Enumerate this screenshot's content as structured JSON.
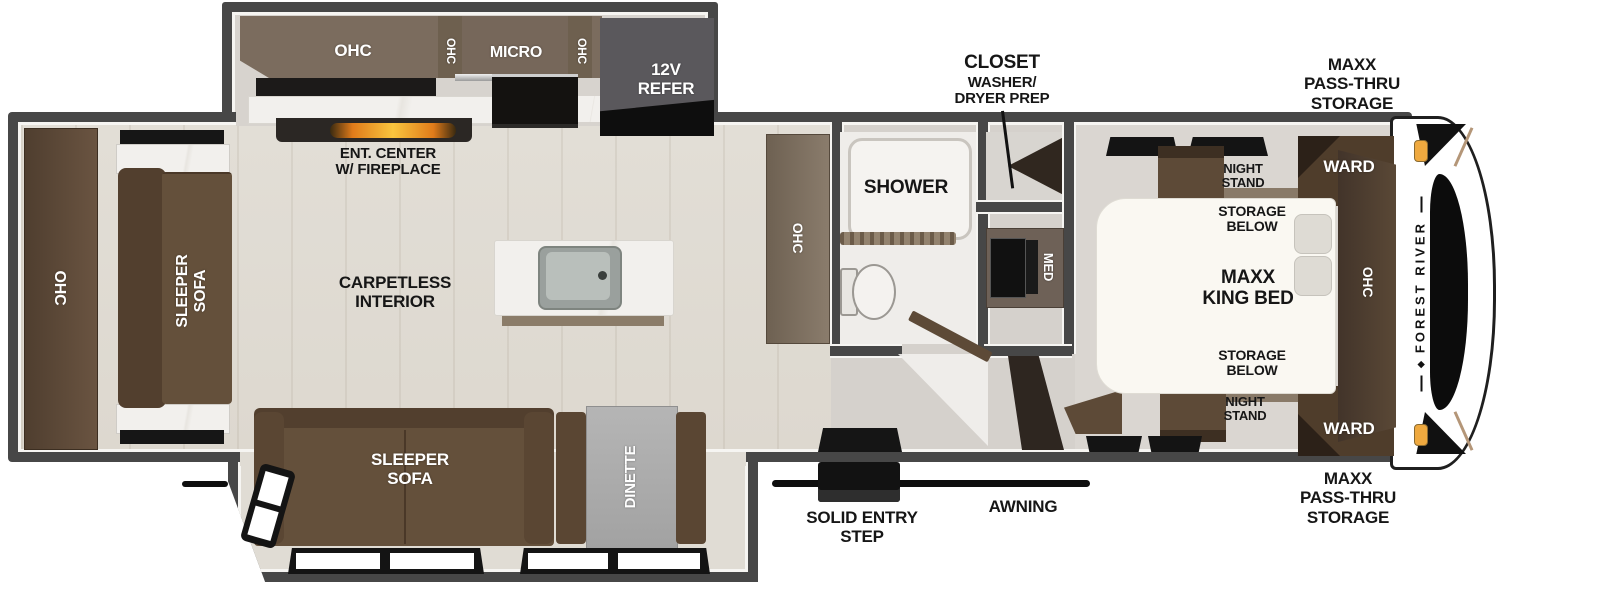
{
  "floorplan": {
    "kitchen": {
      "ohc": "OHC",
      "ohc_vert_left": "OHC",
      "micro": "MICRO",
      "ohc_vert_right": "OHC",
      "refer": "12V\nREFER",
      "ent_center": "ENT. CENTER\nW/ FIREPLACE"
    },
    "living": {
      "rear_ohc": "OHC",
      "rear_sleeper_sofa": "SLEEPER\nSOFA",
      "carpetless": "CARPETLESS\nINTERIOR",
      "sleeper_sofa": "SLEEPER\nSOFA",
      "dinette": "DINETTE",
      "pantry_ohc": "OHC"
    },
    "bath": {
      "shower": "SHOWER",
      "med": "MED",
      "closet_title": "CLOSET",
      "closet_sub": "WASHER/\nDRYER PREP"
    },
    "bedroom": {
      "night_stand_top": "NIGHT\nSTAND",
      "ward_top": "WARD",
      "storage_below_top": "STORAGE\nBELOW",
      "king_bed": "MAXX\nKING BED",
      "storage_below_bottom": "STORAGE\nBELOW",
      "night_stand_bottom": "NIGHT\nSTAND",
      "ward_bottom": "WARD",
      "ohc": "OHC"
    },
    "exterior": {
      "pass_thru_top": "MAXX\nPASS-THRU\nSTORAGE",
      "pass_thru_bottom": "MAXX\nPASS-THRU\nSTORAGE",
      "solid_entry_step": "SOLID ENTRY\nSTEP",
      "awning": "AWNING",
      "brand": "FOREST RIVER"
    },
    "colors": {
      "wall": "#474747",
      "cabinet_brown": "#5d4a37",
      "sofa_brown": "#64503b",
      "counter_taupe": "#7b6c5e",
      "marble": "#f1efec",
      "fireplace_orange": "#f7a33c",
      "marker_light_orange": "#efa93f",
      "label_black": "#161616",
      "label_white": "#ffffff"
    }
  }
}
